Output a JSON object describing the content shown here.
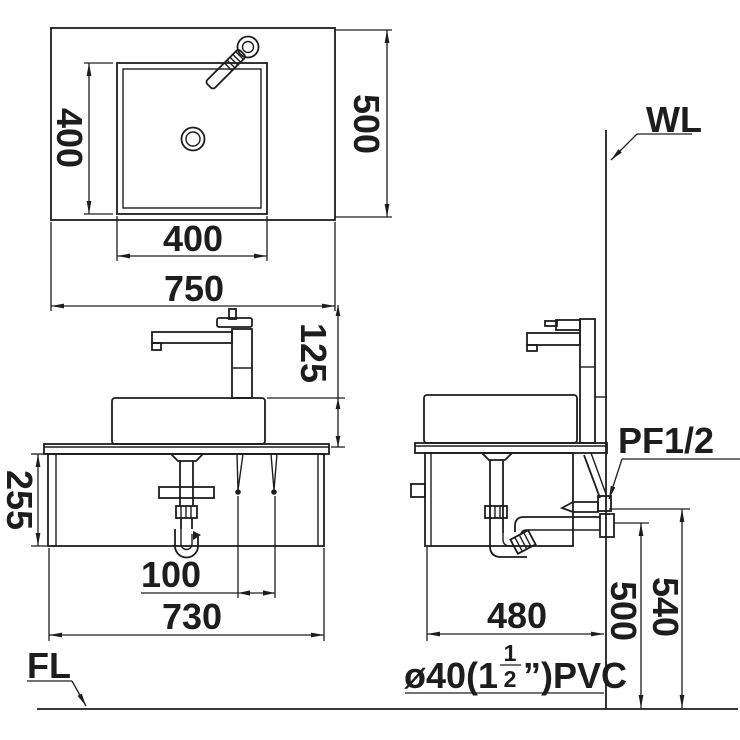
{
  "drawing_type": "sanitary-ware installation drawing",
  "plan_view": {
    "dim_sink_depth": "400",
    "dim_counter_depth": "500",
    "dim_sink_width": "400",
    "dim_counter_width": "750"
  },
  "front_view": {
    "dim_basin_height": "125",
    "dim_cabinet_height": "255",
    "dim_bracket_spacing": "100",
    "dim_cabinet_width": "730"
  },
  "side_view": {
    "dim_cabinet_depth": "480",
    "dim_drain_outlet_height": "500",
    "dim_supply_height": "540"
  },
  "labels": {
    "wall_line": "WL",
    "floor_line": "FL",
    "supply_connection": "PF1/2",
    "pipe_prefix": "ø40(1",
    "pipe_fraction_numerator": "1",
    "pipe_fraction_denominator": "2",
    "pipe_suffix": "”)PVC"
  },
  "colors": {
    "line": "#1d1d1d",
    "background": "#ffffff"
  }
}
